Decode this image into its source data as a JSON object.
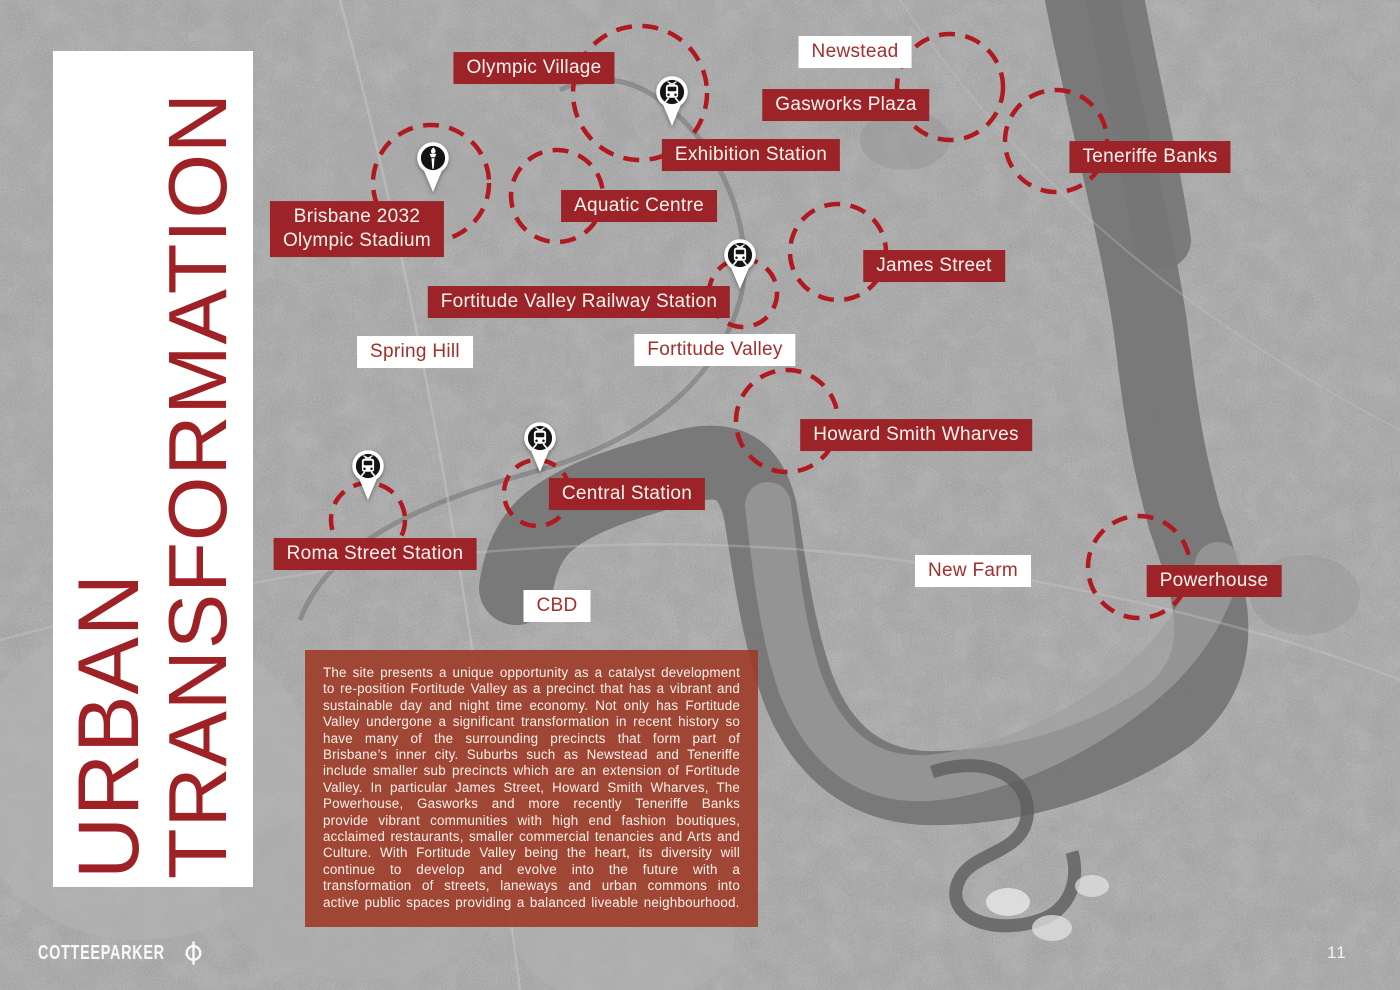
{
  "page": {
    "title_vertical": {
      "line1": "URBAN",
      "line2": "TRANSFORMATION"
    },
    "brand": "COTTEEPARKER",
    "brand_icon": "phi-circle-icon",
    "page_number": "11",
    "colors": {
      "label_red_bg": "#9c2428",
      "label_white_bg": "#ffffff",
      "label_red_text": "#a42e2b",
      "title_red": "#9e2126",
      "circle_red": "#b0191f",
      "description_bg": "rgba(158,55,36,0.87)"
    }
  },
  "map": {
    "labels": [
      {
        "id": "olympic-village",
        "text": "Olympic Village",
        "style": "red",
        "x": 534,
        "y": 68
      },
      {
        "id": "newstead",
        "text": "Newstead",
        "style": "white",
        "x": 855,
        "y": 52
      },
      {
        "id": "gasworks-plaza",
        "text": "Gasworks Plaza",
        "style": "red",
        "x": 846,
        "y": 105
      },
      {
        "id": "exhibition-station",
        "text": "Exhibition Station",
        "style": "red",
        "x": 751,
        "y": 155
      },
      {
        "id": "teneriffe-banks",
        "text": "Teneriffe Banks",
        "style": "red",
        "x": 1150,
        "y": 157
      },
      {
        "id": "aquatic-centre",
        "text": "Aquatic Centre",
        "style": "red",
        "x": 639,
        "y": 206
      },
      {
        "id": "brisbane-2032-olympic-stadium",
        "text": "Brisbane 2032\nOlympic Stadium",
        "style": "red",
        "x": 357,
        "y": 229
      },
      {
        "id": "james-street",
        "text": "James Street",
        "style": "red",
        "x": 934,
        "y": 266
      },
      {
        "id": "fortitude-valley-railway-station",
        "text": "Fortitude Valley Railway Station",
        "style": "red",
        "x": 579,
        "y": 302
      },
      {
        "id": "spring-hill",
        "text": "Spring Hill",
        "style": "white",
        "x": 415,
        "y": 352
      },
      {
        "id": "fortitude-valley",
        "text": "Fortitude Valley",
        "style": "white",
        "x": 715,
        "y": 350
      },
      {
        "id": "howard-smith-wharves",
        "text": "Howard Smith Wharves",
        "style": "red",
        "x": 916,
        "y": 435
      },
      {
        "id": "central-station",
        "text": "Central Station",
        "style": "red",
        "x": 627,
        "y": 494
      },
      {
        "id": "roma-street-station",
        "text": "Roma Street Station",
        "style": "red",
        "x": 375,
        "y": 554
      },
      {
        "id": "new-farm",
        "text": "New Farm",
        "style": "white",
        "x": 973,
        "y": 571
      },
      {
        "id": "powerhouse",
        "text": "Powerhouse",
        "style": "red",
        "x": 1214,
        "y": 581
      },
      {
        "id": "cbd",
        "text": "CBD",
        "style": "white",
        "x": 557,
        "y": 606
      }
    ],
    "pins": [
      {
        "id": "olympic-stadium-pin",
        "type": "torch",
        "x": 433,
        "y": 158
      },
      {
        "id": "exhibition-station-pin",
        "type": "train",
        "x": 672,
        "y": 92
      },
      {
        "id": "fortitude-valley-station-pin",
        "type": "train",
        "x": 740,
        "y": 255
      },
      {
        "id": "central-station-pin",
        "type": "train",
        "x": 540,
        "y": 438
      },
      {
        "id": "roma-street-station-pin",
        "type": "train",
        "x": 368,
        "y": 466
      }
    ],
    "circles": [
      {
        "id": "olympic-stadium-circle",
        "cx": 431,
        "cy": 183,
        "r": 58
      },
      {
        "id": "aquatic-centre-circle",
        "cx": 557,
        "cy": 196,
        "r": 46
      },
      {
        "id": "exhibition-circle",
        "cx": 640,
        "cy": 93,
        "r": 67
      },
      {
        "id": "newstead-circle",
        "cx": 950,
        "cy": 87,
        "r": 53
      },
      {
        "id": "teneriffe-banks-circle",
        "cx": 1056,
        "cy": 141,
        "r": 51
      },
      {
        "id": "james-street-circle",
        "cx": 838,
        "cy": 252,
        "r": 48
      },
      {
        "id": "fortitude-valley-station-circle",
        "cx": 743,
        "cy": 293,
        "r": 34
      },
      {
        "id": "howard-smith-wharves-circle",
        "cx": 787,
        "cy": 421,
        "r": 51
      },
      {
        "id": "central-station-circle",
        "cx": 537,
        "cy": 493,
        "r": 33
      },
      {
        "id": "roma-street-station-circle",
        "cx": 368,
        "cy": 520,
        "r": 37
      },
      {
        "id": "powerhouse-circle",
        "cx": 1139,
        "cy": 567,
        "r": 51
      }
    ]
  },
  "description": {
    "text": "The site presents a unique opportunity as a catalyst development to re-position Fortitude Valley as a precinct that has a vibrant and sustainable day and night time economy. Not only has Fortitude Valley undergone a significant transformation in recent history so have many of the surrounding precincts that form part of Brisbane’s inner city. Suburbs such as Newstead and Teneriffe include smaller sub precincts which are an extension of Fortitude Valley.  In particular James Street, Howard Smith Wharves, The Powerhouse, Gasworks and more recently Teneriffe Banks provide vibrant communities with high end fashion boutiques, acclaimed restaurants, smaller commercial tenancies and Arts and Culture. With Fortitude Valley being the heart, its diversity will continue to develop and evolve into the future with a transformation of streets, laneways and urban commons into active public spaces providing a balanced liveable neighbourhood."
  }
}
